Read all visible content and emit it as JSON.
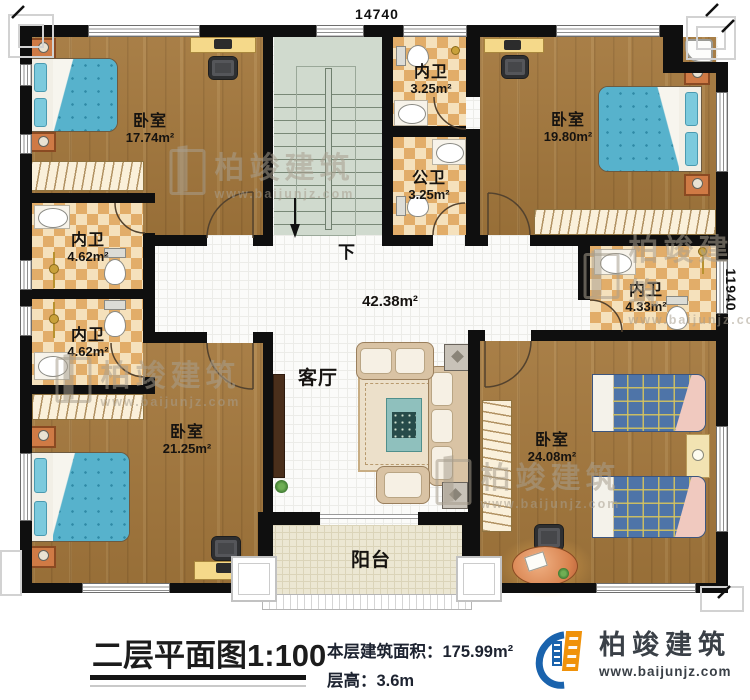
{
  "dimensions": {
    "top": "14740",
    "right": "11940"
  },
  "stairs": {
    "down": "下"
  },
  "rooms": [
    {
      "label": "卧室",
      "area": "17.74m²"
    },
    {
      "label": "内卫",
      "area": "3.25m²"
    },
    {
      "label": "卧室",
      "area": "19.80m²"
    },
    {
      "label": "公卫",
      "area": "3.25m²"
    },
    {
      "label": "内卫",
      "area": "4.62m²"
    },
    {
      "label": "内卫",
      "area": "4.62m²"
    },
    {
      "label": "内卫",
      "area": "4.33m²"
    },
    {
      "label": "",
      "area": "42.38m²"
    },
    {
      "label": "客厅",
      "area": ""
    },
    {
      "label": "卧室",
      "area": "21.25m²"
    },
    {
      "label": "卧室",
      "area": "24.08m²"
    },
    {
      "label": "阳台",
      "area": ""
    }
  ],
  "caption": {
    "title": "二层平面图1:100",
    "area_line": "本层建筑面积：175.99m²",
    "height_line": "层高：3.6m"
  },
  "logo": {
    "name": "柏竣建筑",
    "url": "www.baijunjz.com"
  },
  "watermark": {
    "name": "柏竣建筑",
    "url": "www.baijunjz.com"
  },
  "colors": {
    "logo_blue": "#1a63ad",
    "logo_orange": "#f0920a",
    "wall": "#0f0f0f"
  }
}
